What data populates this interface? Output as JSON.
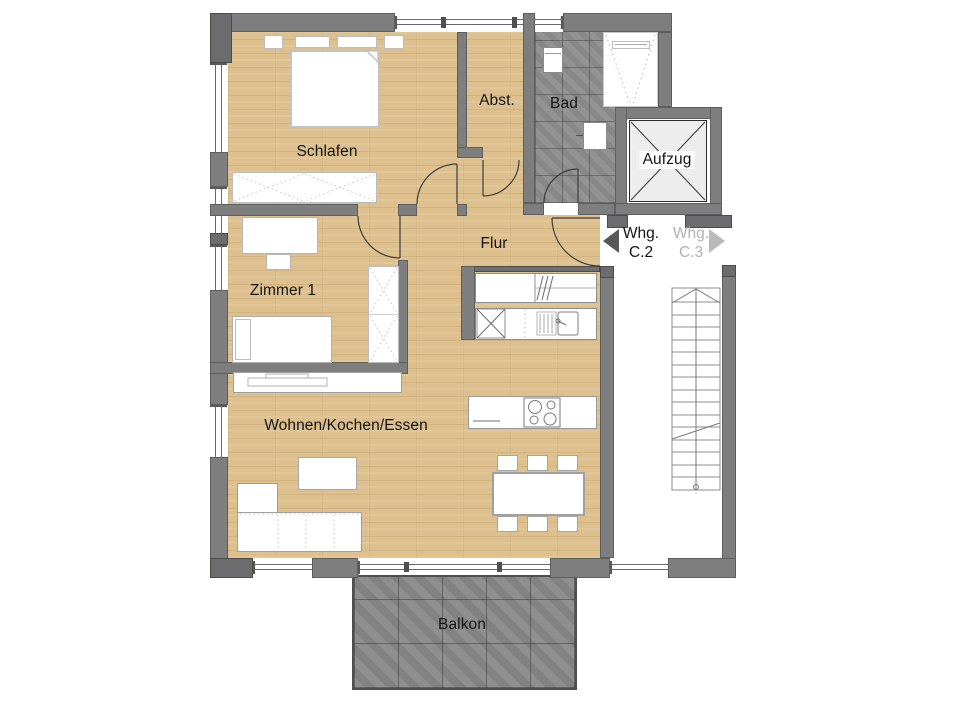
{
  "rooms": {
    "schlafen": {
      "label": "Schlafen"
    },
    "abstellraum": {
      "label": "Abst."
    },
    "bad": {
      "label": "Bad"
    },
    "aufzug": {
      "label": "Aufzug"
    },
    "flur": {
      "label": "Flur"
    },
    "zimmer1": {
      "label": "Zimmer 1"
    },
    "wohnen": {
      "label": "Wohnen/Kochen/Essen"
    },
    "balkon": {
      "label": "Balkon"
    }
  },
  "landing": {
    "apartment_current": {
      "line1": "Whg.",
      "line2": "C.2",
      "color": "#141414"
    },
    "apartment_other": {
      "line1": "Whg.",
      "line2": "C.3",
      "color": "#b2b2b4"
    }
  },
  "stairs": {
    "treads": 16
  },
  "colors": {
    "floor_wood": "#dec08f",
    "wall_gray": "#7e7e7e",
    "bath_tile": "#8d8d8d",
    "balcony_tile": "#898989",
    "arrow_dark": "#58585a",
    "arrow_light": "#bababc",
    "elevator_car": "#ededed"
  }
}
